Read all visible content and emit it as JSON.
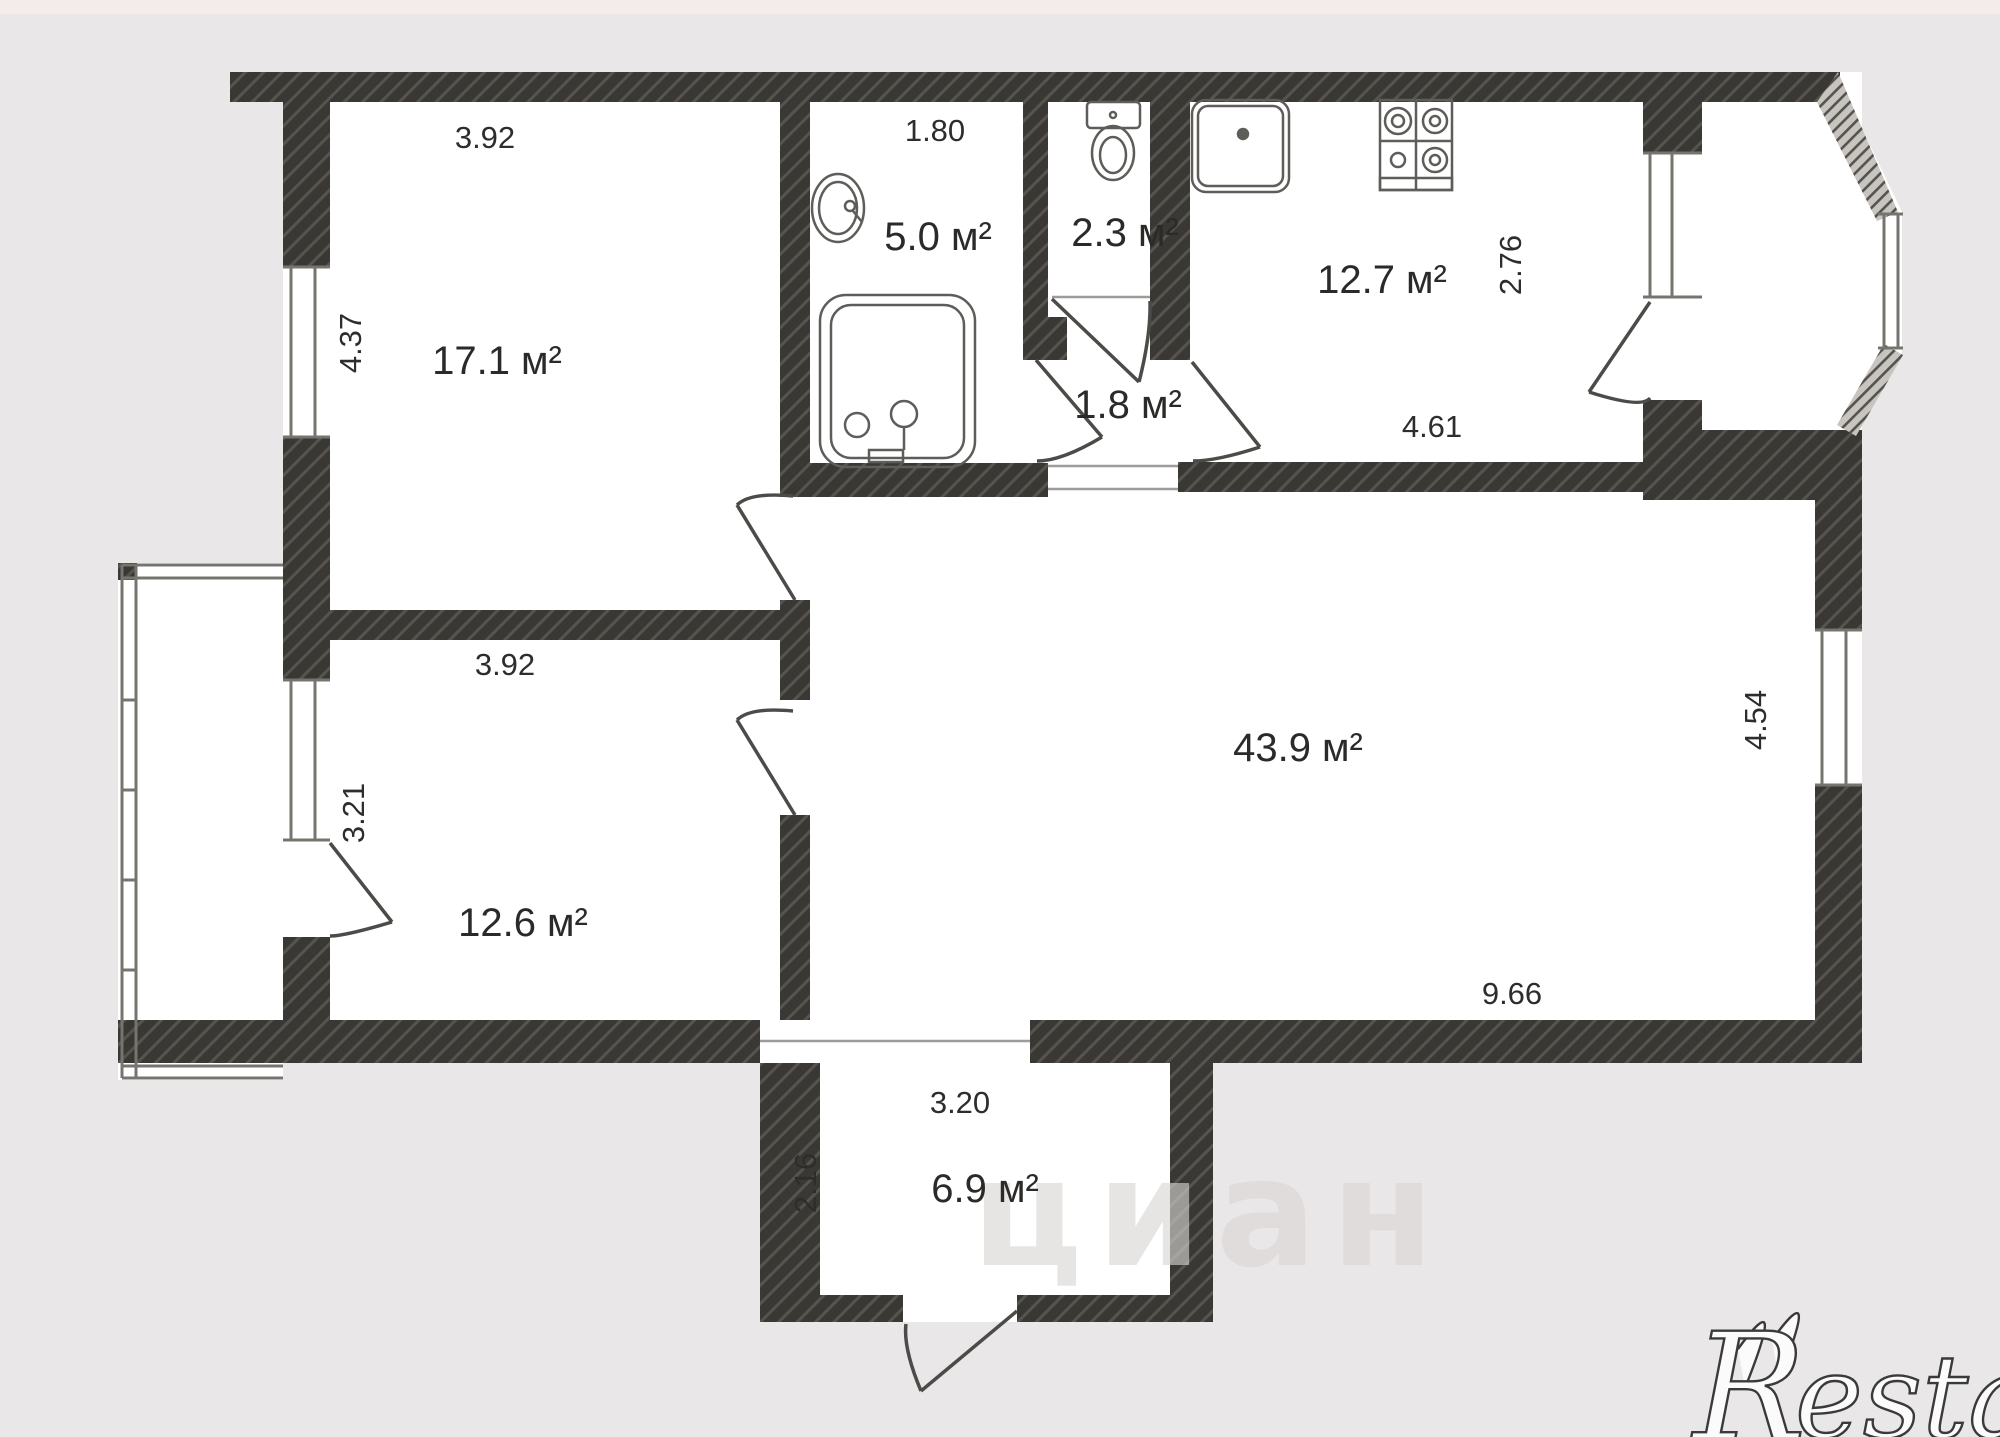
{
  "plan": {
    "type": "apartment-floor-plan",
    "units": "м",
    "rooms": {
      "bedroom1": {
        "name": "room-top-left",
        "area": "17.1 м²",
        "width": "3.92",
        "depth": "4.37"
      },
      "bathroom": {
        "name": "bathroom",
        "area": "5.0 м²",
        "width": "1.80"
      },
      "toilet": {
        "name": "wc",
        "area": "2.3 м²"
      },
      "kitchen": {
        "name": "kitchen",
        "area": "12.7 м²",
        "width": "4.61",
        "depth": "2.76"
      },
      "hall": {
        "name": "inner-hall",
        "area": "1.8 м²"
      },
      "living": {
        "name": "living-room",
        "area": "43.9 м²",
        "width": "9.66",
        "depth": "4.54"
      },
      "bedroom2": {
        "name": "room-bottom-left",
        "area": "12.6 м²",
        "width": "3.92",
        "depth": "3.21"
      },
      "entrance": {
        "name": "entrance-hall",
        "area": "6.9 м²",
        "width": "3.20",
        "depth": "2.16"
      }
    },
    "fixtures": [
      "bathtub",
      "wash-basin",
      "toilet-bowl",
      "kitchen-sink",
      "stove"
    ],
    "watermarks": {
      "cian": "циан",
      "restate_initial": "R",
      "restate_rest": "estate"
    },
    "colors": {
      "background": "#e9e7e7",
      "floor": "#ffffff",
      "wall": "#3a3834",
      "wall_hatch": "#5f5c55",
      "text": "#2b2a28"
    }
  }
}
